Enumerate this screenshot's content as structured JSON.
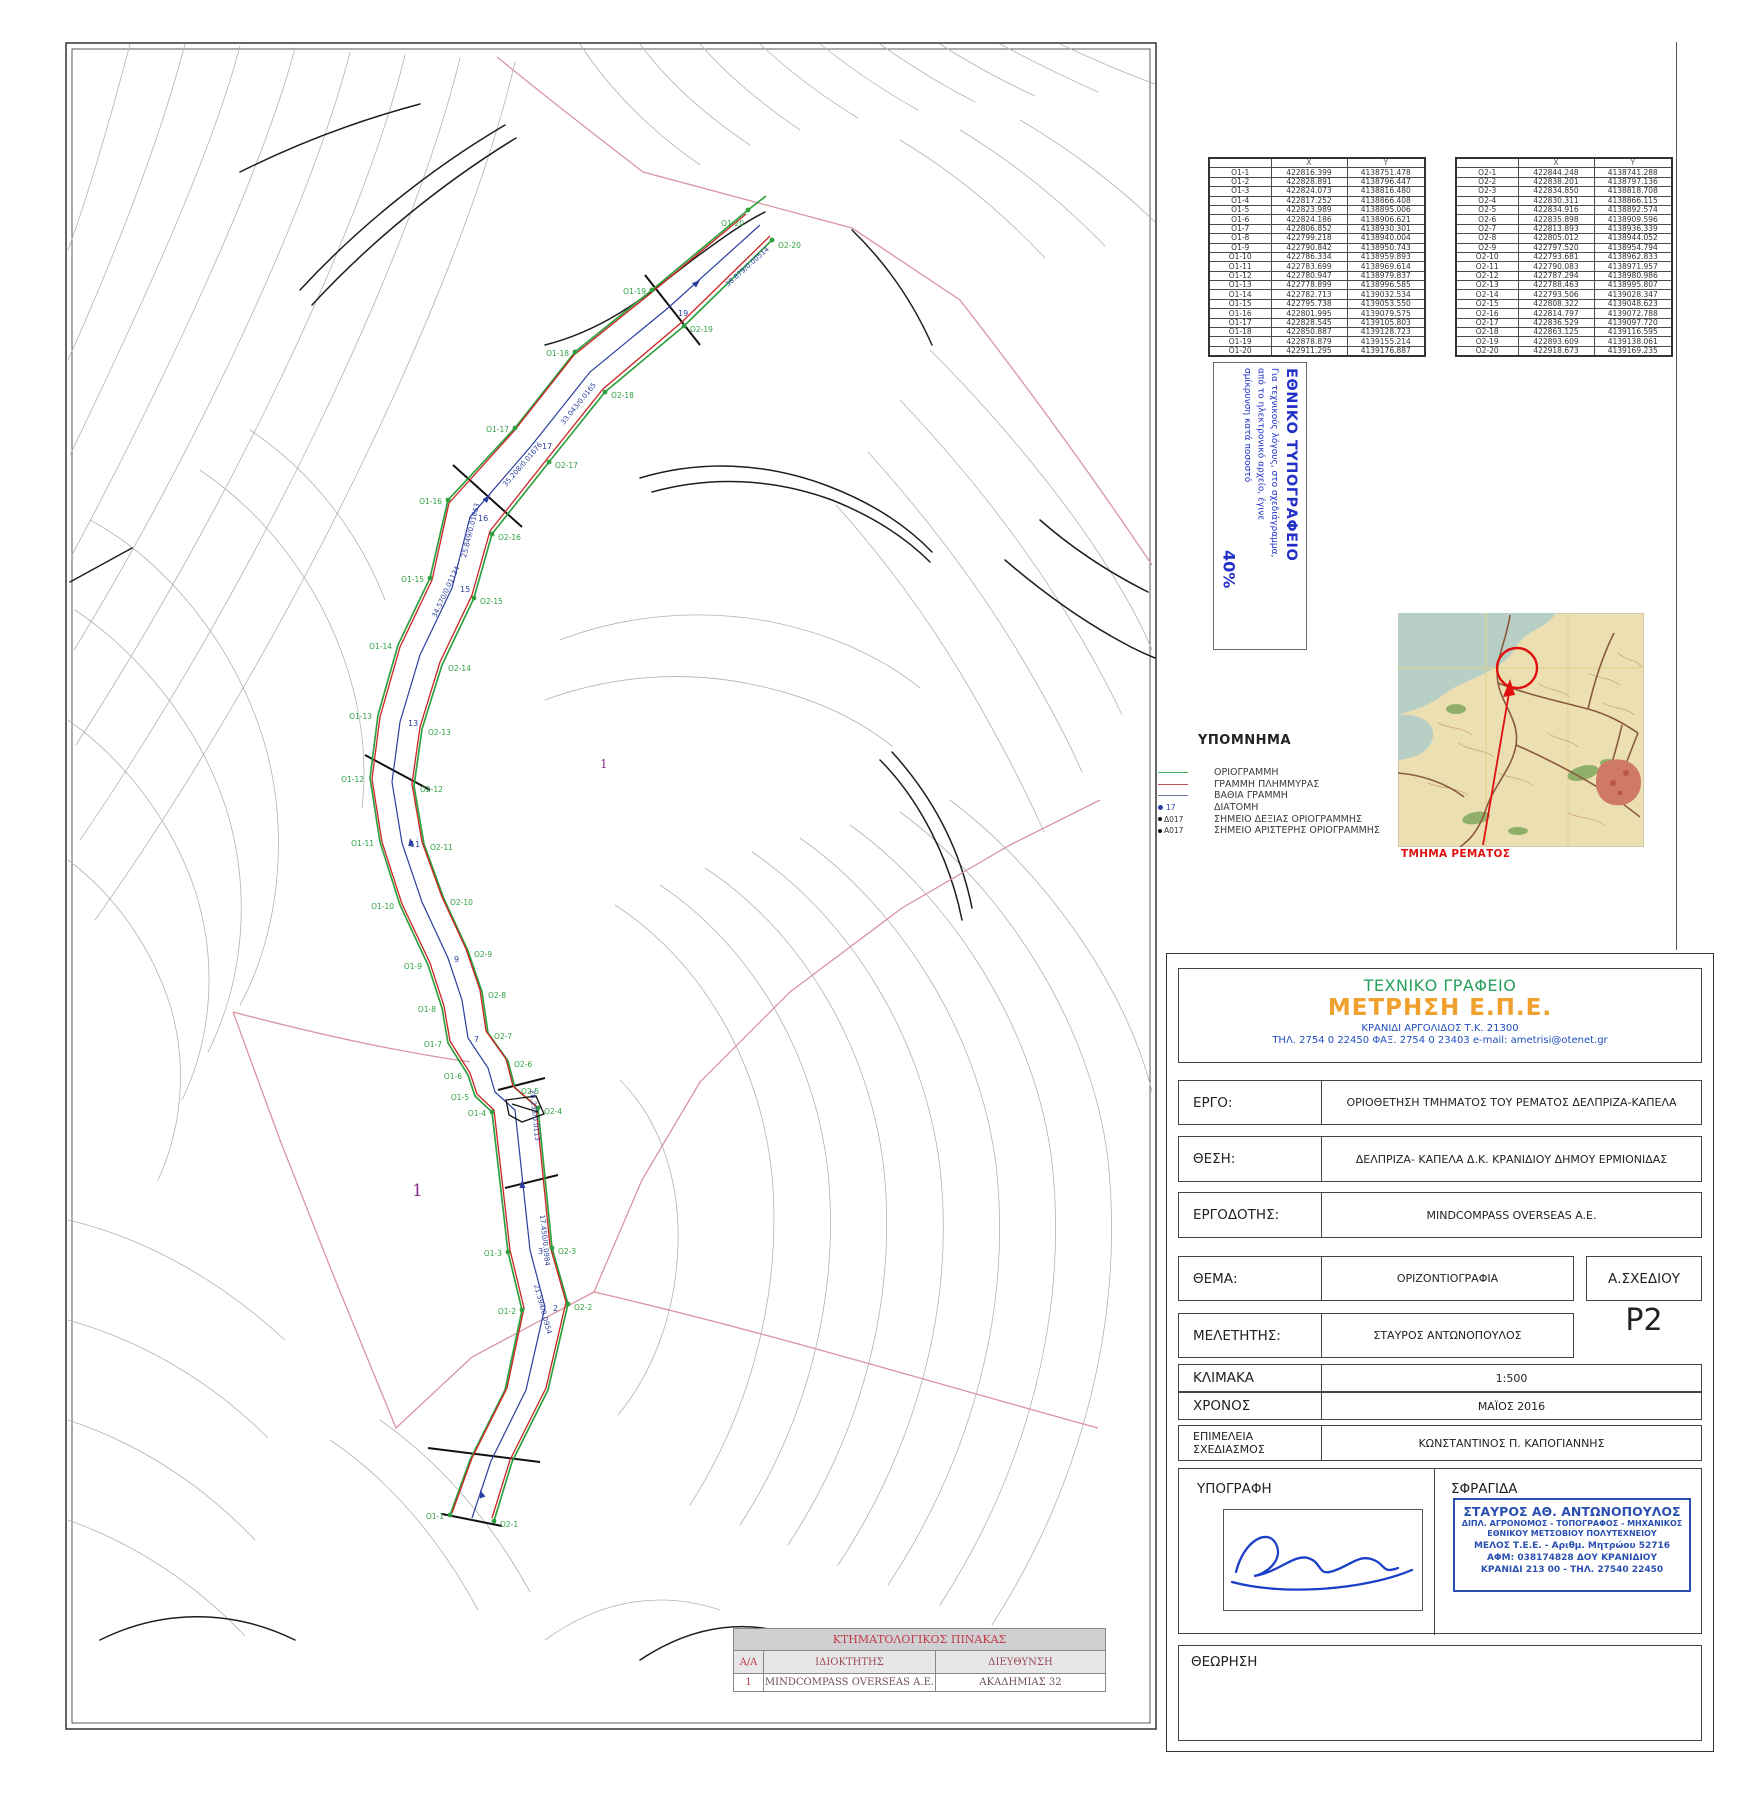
{
  "colors": {
    "boundary_green": "#2fa040",
    "flood_red": "#cc2222",
    "thalweg_blue": "#2b3f9e",
    "parcel_pink": "#d995a0",
    "stamp_blue": "#2230c8",
    "company_green": "#27a05c",
    "company_orange": "#f0a02c",
    "company_blue": "#1f4fc0",
    "red_accent": "#e01010"
  },
  "coord_tables": {
    "o1": {
      "headers": [
        "",
        "X",
        "Y"
      ],
      "rows": [
        [
          "O1-1",
          "422816.399",
          "4138751.478"
        ],
        [
          "O1-2",
          "422828.891",
          "4138796.447"
        ],
        [
          "O1-3",
          "422824.073",
          "4138816.480"
        ],
        [
          "O1-4",
          "422817.252",
          "4138866.408"
        ],
        [
          "O1-5",
          "422823.989",
          "4138895.006"
        ],
        [
          "O1-6",
          "422824.186",
          "4138906.621"
        ],
        [
          "O1-7",
          "422806.852",
          "4138930.301"
        ],
        [
          "O1-8",
          "422799.218",
          "4138940.004"
        ],
        [
          "O1-9",
          "422790.842",
          "4138950.743"
        ],
        [
          "O1-10",
          "422786.334",
          "4138959.893"
        ],
        [
          "O1-11",
          "422783.699",
          "4138969.614"
        ],
        [
          "O1-12",
          "422780.947",
          "4138979.837"
        ],
        [
          "O1-13",
          "422778.899",
          "4138996.585"
        ],
        [
          "O1-14",
          "422782.713",
          "4139032.534"
        ],
        [
          "O1-15",
          "422795.738",
          "4139053.550"
        ],
        [
          "O1-16",
          "422801.995",
          "4139079.575"
        ],
        [
          "O1-17",
          "422828.545",
          "4139105.803"
        ],
        [
          "O1-18",
          "422850.887",
          "4139128.723"
        ],
        [
          "O1-19",
          "422878.879",
          "4139155.214"
        ],
        [
          "O1-20",
          "422911.295",
          "4139176.887"
        ]
      ]
    },
    "o2": {
      "headers": [
        "",
        "X",
        "Y"
      ],
      "rows": [
        [
          "O2-1",
          "422844.248",
          "4138741.288"
        ],
        [
          "O2-2",
          "422838.201",
          "4138797.136"
        ],
        [
          "O2-3",
          "422834.850",
          "4138818.708"
        ],
        [
          "O2-4",
          "422830.311",
          "4138866.115"
        ],
        [
          "O2-5",
          "422834.916",
          "4138892.574"
        ],
        [
          "O2-6",
          "422835.898",
          "4138909.596"
        ],
        [
          "O2-7",
          "422813.893",
          "4138936.339"
        ],
        [
          "O2-8",
          "422805.012",
          "4138944.052"
        ],
        [
          "O2-9",
          "422797.520",
          "4138954.794"
        ],
        [
          "O2-10",
          "422793.681",
          "4138962.833"
        ],
        [
          "O2-11",
          "422790.083",
          "4138971.957"
        ],
        [
          "O2-12",
          "422787.294",
          "4138980.986"
        ],
        [
          "O2-13",
          "422788.463",
          "4138995.807"
        ],
        [
          "O2-14",
          "422793.506",
          "4139028.347"
        ],
        [
          "O2-15",
          "422808.322",
          "4139048.623"
        ],
        [
          "O2-16",
          "422814.797",
          "4139072.788"
        ],
        [
          "O2-17",
          "422836.529",
          "4139097.720"
        ],
        [
          "O2-18",
          "422863.125",
          "4139116.595"
        ],
        [
          "O2-19",
          "422893.609",
          "4139138.061"
        ],
        [
          "O2-20",
          "422918.673",
          "4139169.235"
        ]
      ]
    }
  },
  "print_stamp": {
    "title": "ΕΘΝΙΚΟ ΤΥΠΟΓΡΑΦΕΙΟ",
    "line1": "Για τεχνικούς λόγους, στο σχεδιάγραμμα,",
    "line2": "από το ηλεκτρονικό αρχείο, έγινε",
    "line3": "σμίκρυνση κατά ποσοστό",
    "percent": "40%"
  },
  "legend": {
    "title": "ΥΠΟΜΝΗΜΑ",
    "items": [
      {
        "label": "ΟΡΙΟΓΡΑΜΜΗ"
      },
      {
        "label": "ΓΡΑΜΜΗ ΠΛΗΜΜΥΡΑΣ"
      },
      {
        "label": "ΒΑΘΙΑ ΓΡΑΜΜΗ"
      },
      {
        "marker": "17",
        "label": "ΔΙΑΤΟΜΗ"
      },
      {
        "marker": "Δ017",
        "label": "ΣΗΜΕΙΟ ΔΕΞΙΑΣ ΟΡΙΟΓΡΑΜΜΗΣ"
      },
      {
        "marker": "A017",
        "label": "ΣΗΜΕΙΟ ΑΡΙΣΤΕΡΗΣ ΟΡΙΟΓΡΑΜΜΗΣ"
      }
    ]
  },
  "location_map": {
    "caption": "ΤΜΗΜΑ ΡΕΜΑΤΟΣ"
  },
  "title_block": {
    "office_type": "ΤΕΧΝΙΚΟ ΓΡΑΦΕΙΟ",
    "company": "ΜΕΤΡΗΣΗ Ε.Π.Ε.",
    "address": "ΚΡΑΝΙΔΙ ΑΡΓΟΛΙΔΟΣ Τ.Κ. 21300",
    "contact": "ΤΗΛ. 2754 0 22450 ΦΑΞ. 2754 0 23403    e-mail: ametrisi@otenet.gr",
    "ergo_label": "ΕΡΓΟ:",
    "ergo_value": "ΟΡΙΟΘΕΤΗΣΗ ΤΜΗΜΑΤΟΣ ΤΟΥ ΡΕΜΑΤΟΣ ΔΕΛΠΡΙΖΑ-ΚΑΠΕΛΑ",
    "thesi_label": "ΘΕΣΗ:",
    "thesi_value": "ΔΕΛΠΡΙΖΑ- ΚΑΠΕΛΑ Δ.Κ. ΚΡΑΝΙΔΙΟΥ ΔΗΜΟΥ ΕΡΜΙΟΝΙΔΑΣ",
    "ergodotis_label": "ΕΡΓΟΔΟΤΗΣ:",
    "ergodotis_value": "MINDCOMPASS OVERSEAS A.E.",
    "thema_label": "ΘΕΜΑ:",
    "thema_value": "ΟΡΙΖΟΝΤΙΟΓΡΑΦΙΑ",
    "sxediou_label": "Α.ΣΧΕΔΙΟΥ",
    "sxediou_value": "P2",
    "meletitis_label": "ΜΕΛΕΤΗΤΗΣ:",
    "meletitis_value": "ΣΤΑΥΡΟΣ ΑΝΤΩΝΟΠΟΥΛΟΣ",
    "klimaka_label": "ΚΛΙΜΑΚΑ",
    "klimaka_value": "1:500",
    "xronos_label": "ΧΡΟΝΟΣ",
    "xronos_value": "ΜΑΪΟΣ  2016",
    "epimeleia_label1": "ΕΠΙΜΕΛΕΙΑ",
    "epimeleia_label2": "ΣΧΕΔΙΑΣΜΟΣ",
    "epimeleia_value": "ΚΩΝΣΤΑΝΤΙΝΟΣ Π. ΚΑΠΟΓΙΑΝΝΗΣ",
    "ypografi_label": "ΥΠΟΓΡΑΦΗ",
    "sfragida_label": "ΣΦΡΑΓΙΔΑ",
    "theorisi_label": "ΘΕΩΡΗΣΗ",
    "stamp": {
      "name": "ΣΤΑΥΡΟΣ ΑΘ. ΑΝΤΩΝΟΠΟΥΛΟΣ",
      "line2": "ΔΙΠΛ. ΑΓΡΟΝΟΜΟΣ - ΤΟΠΟΓΡΑΦΟΣ - ΜΗΧΑΝΙΚΟΣ",
      "line3": "ΕΘΝΙΚΟΥ ΜΕΤΣΟΒΙΟΥ ΠΟΛΥΤΕΧΝΕΙΟΥ",
      "line4": "ΜΕΛΟΣ Τ.Ε.Ε. - Αριθμ. Μητρώου 52716",
      "line5": "ΑΦΜ: 038174828  ΔΟΥ ΚΡΑΝΙΔΙΟΥ",
      "line6": "ΚΡΑΝΙΔΙ  213 00 - ΤΗΛ. 27540 22450"
    }
  },
  "cadastral": {
    "title": "ΚΤΗΜΑΤΟΛΟΓΙΚΟΣ ΠΙΝΑΚΑΣ",
    "headers": [
      "Α/Α",
      "ΙΔΙΟΚΤΗΤΗΣ",
      "ΔΙΕΥΘΥΝΣΗ"
    ],
    "row": [
      "1",
      "MINDCOMPASS OVERSEAS A.E.",
      "ΑΚΑΔΗΜΙΑΣ 32"
    ]
  },
  "map": {
    "parcel": "1",
    "o1": [
      "O1-1",
      "O1-2",
      "O1-3",
      "O1-4",
      "O1-5",
      "O1-6",
      "O1-7",
      "O1-8",
      "O1-9",
      "O1-10",
      "O1-11",
      "O1-12",
      "O1-13",
      "O1-14",
      "O1-15",
      "O1-16",
      "O1-17",
      "O1-18",
      "O1-19",
      "O1-20"
    ],
    "o2": [
      "O2-1",
      "O2-2",
      "O2-3",
      "O2-4",
      "O2-5",
      "O2-6",
      "O2-7",
      "O2-8",
      "O2-9",
      "O2-10",
      "O2-11",
      "O2-12",
      "O2-13",
      "O2-14",
      "O2-15",
      "O2-16",
      "O2-17",
      "O2-18",
      "O2-19",
      "O2-20"
    ],
    "stations": [
      "19",
      "17",
      "16",
      "15",
      "13",
      "11",
      "9",
      "7",
      "3",
      "2"
    ],
    "distances": [
      "38.879/0.00514",
      "33.043/0.0165",
      "35.208/0.01676",
      "25.849/0.01663",
      "34.570/0.01134",
      "28.235/0.0113",
      "17.450/0.0984",
      "21.594/0.0954"
    ]
  }
}
